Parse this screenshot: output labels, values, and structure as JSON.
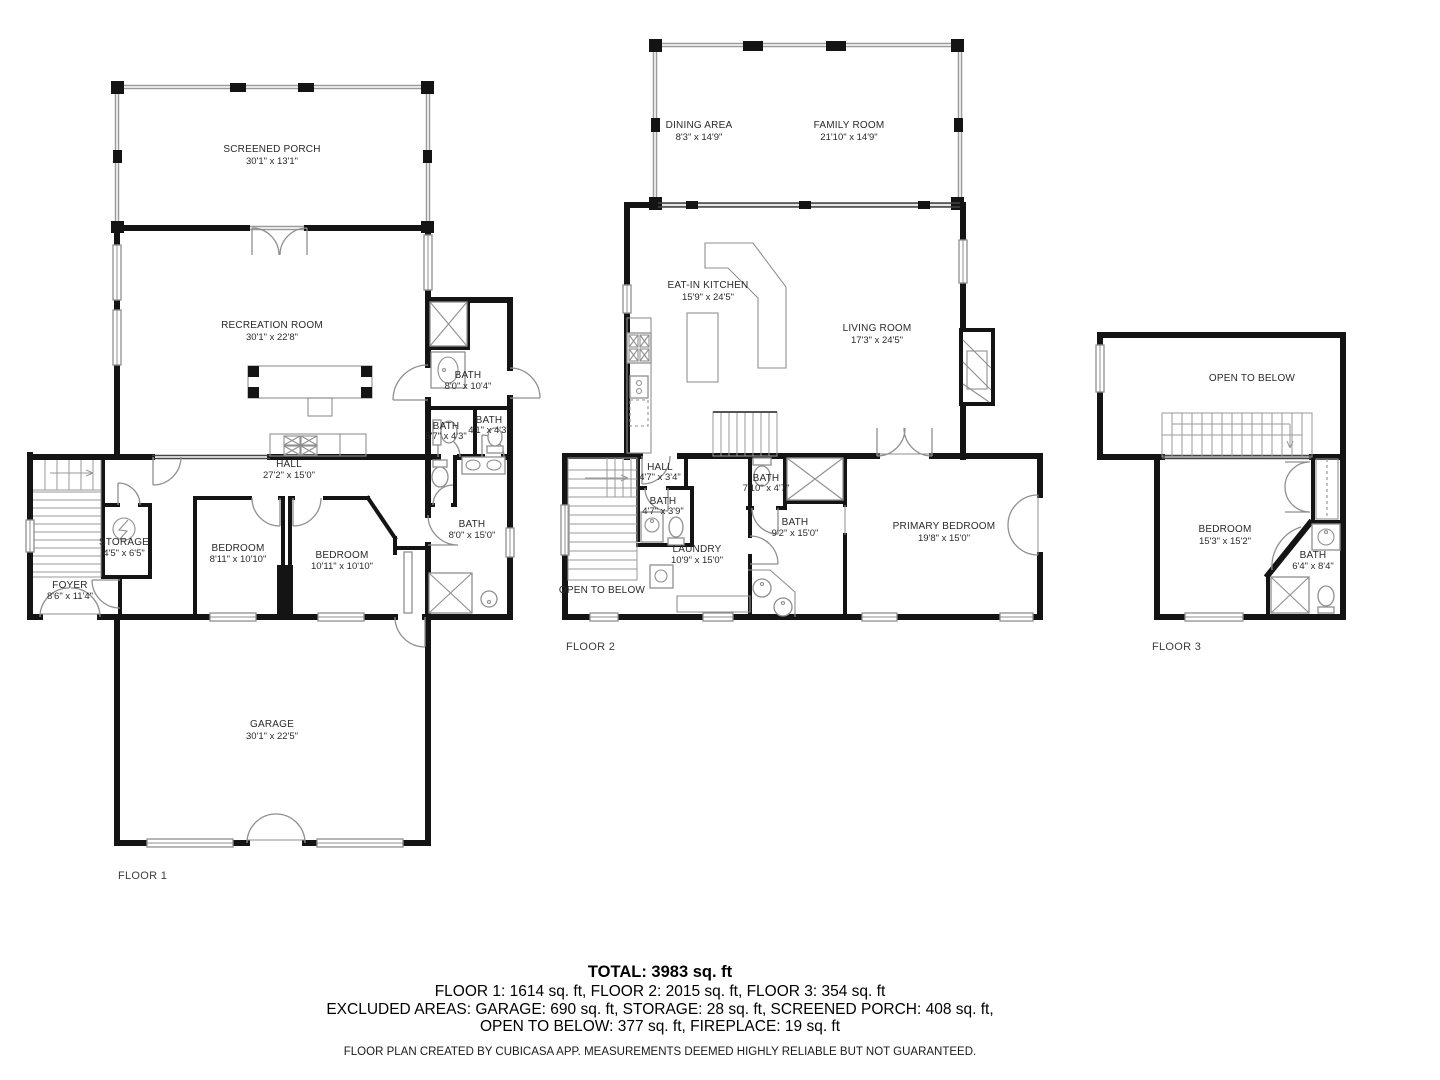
{
  "floor1": {
    "label": "FLOOR 1",
    "screened_porch": {
      "name": "SCREENED PORCH",
      "dims": "30'1\" x 13'1\""
    },
    "recreation_room": {
      "name": "RECREATION ROOM",
      "dims": "30'1\" x 22'8\""
    },
    "bath_upper": {
      "name": "BATH",
      "dims": "8'0\" x 10'4\""
    },
    "bath_small_left": {
      "name": "BATH",
      "dims": "5'7\" x 4'3\""
    },
    "bath_small_right": {
      "name": "BATH",
      "dims": "4'1\" x 4'3\""
    },
    "hall": {
      "name": "HALL",
      "dims": "27'2\" x 15'0\""
    },
    "storage": {
      "name": "STORAGE",
      "dims": "4'5\" x 6'5\""
    },
    "foyer": {
      "name": "FOYER",
      "dims": "8'6\" x 11'4\""
    },
    "bedroom_left": {
      "name": "BEDROOM",
      "dims": "8'11\" x 10'10\""
    },
    "bedroom_right": {
      "name": "BEDROOM",
      "dims": "10'11\" x 10'10\""
    },
    "bath_lower": {
      "name": "BATH",
      "dims": "8'0\" x 15'0\""
    },
    "garage": {
      "name": "GARAGE",
      "dims": "30'1\" x 22'5\""
    }
  },
  "floor2": {
    "label": "FLOOR 2",
    "dining_area": {
      "name": "DINING AREA",
      "dims": "8'3\" x 14'9\""
    },
    "family_room": {
      "name": "FAMILY ROOM",
      "dims": "21'10\" x 14'9\""
    },
    "eat_in_kitchen": {
      "name": "EAT-IN KITCHEN",
      "dims": "15'9\" x 24'5\""
    },
    "living_room": {
      "name": "LIVING ROOM",
      "dims": "17'3\" x 24'5\""
    },
    "hall": {
      "name": "HALL",
      "dims": "4'7\" x 3'4\""
    },
    "bath_hall": {
      "name": "BATH",
      "dims": "4'7\" x 3'9\""
    },
    "laundry": {
      "name": "LAUNDRY",
      "dims": "10'9\" x 15'0\""
    },
    "bath_small": {
      "name": "BATH",
      "dims": "7'10\" x 4'7\""
    },
    "bath_large": {
      "name": "BATH",
      "dims": "9'2\" x 15'0\""
    },
    "primary_bedroom": {
      "name": "PRIMARY BEDROOM",
      "dims": "19'8\" x 15'0\""
    },
    "open_to_below": {
      "name": "OPEN TO BELOW"
    }
  },
  "floor3": {
    "label": "FLOOR 3",
    "open_to_below": {
      "name": "OPEN TO BELOW"
    },
    "bedroom": {
      "name": "BEDROOM",
      "dims": "15'3\" x 15'2\""
    },
    "bath": {
      "name": "BATH",
      "dims": "6'4\" x 8'4\""
    }
  },
  "summary": {
    "total": "TOTAL: 3983 sq. ft",
    "floors_line": "FLOOR 1: 1614 sq. ft, FLOOR 2: 2015 sq. ft, FLOOR 3: 354 sq. ft",
    "excluded_line1": "EXCLUDED AREAS: GARAGE: 690 sq. ft, STORAGE: 28 sq. ft, SCREENED PORCH: 408 sq. ft,",
    "excluded_line2": "OPEN TO BELOW: 377 sq. ft, FIREPLACE: 19 sq. ft",
    "disclaimer": "FLOOR PLAN CREATED BY CUBICASA APP. MEASUREMENTS DEEMED HIGHLY RELIABLE BUT NOT GUARANTEED."
  }
}
